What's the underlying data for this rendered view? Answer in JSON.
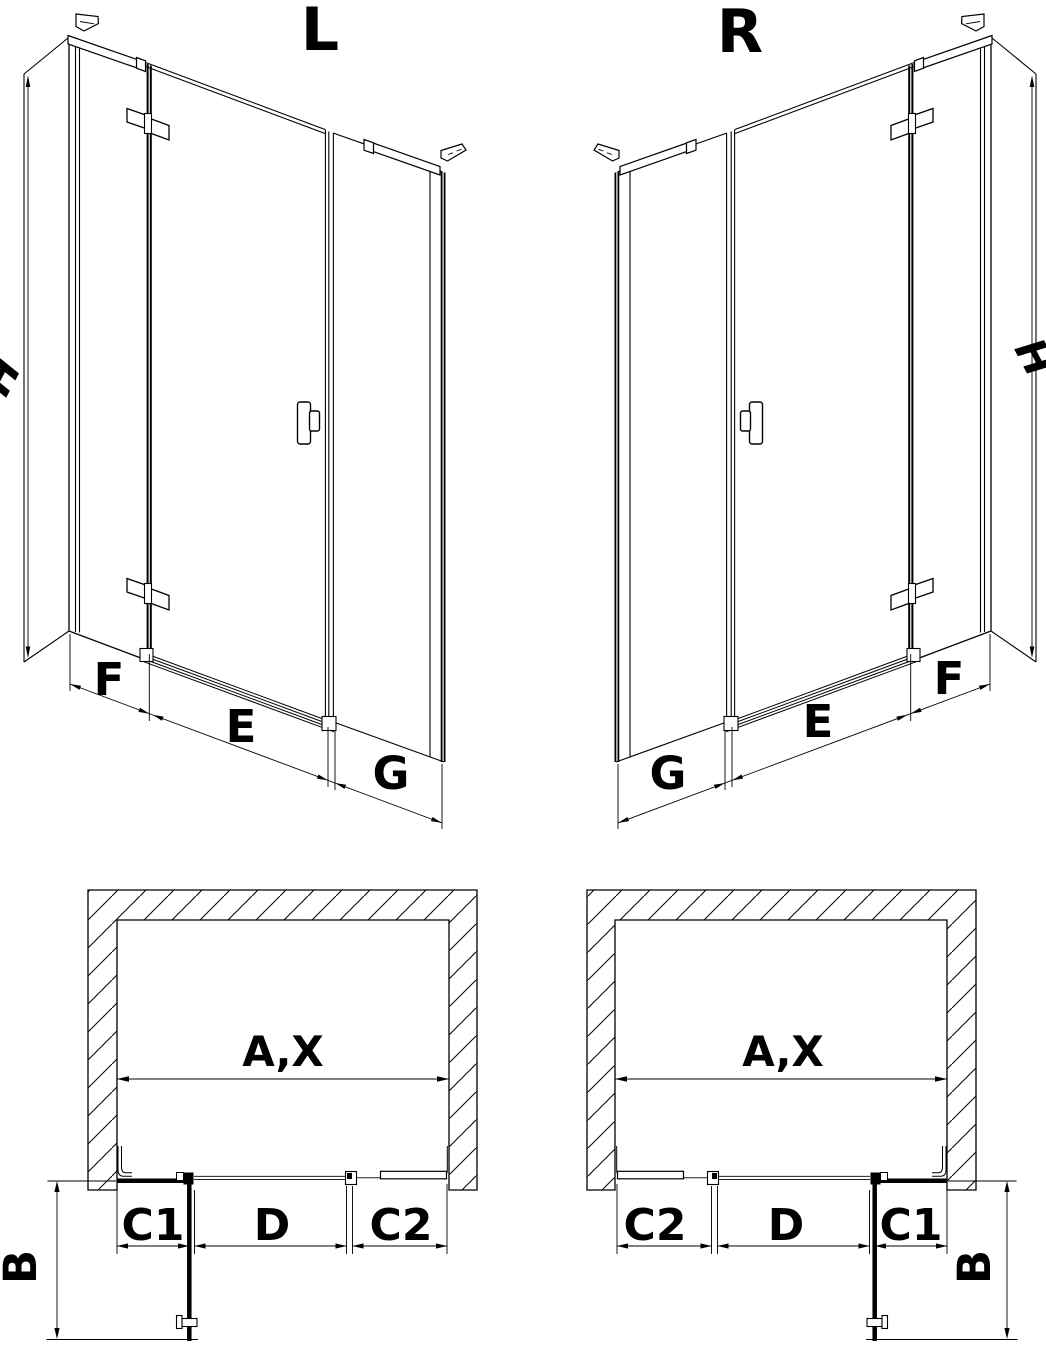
{
  "document": {
    "type": "shower-door-installation-diagram",
    "colors": {
      "line": "#000000",
      "background": "#ffffff"
    }
  },
  "elevations": {
    "left": {
      "label": "L",
      "height": "H",
      "fixed_panel": "F",
      "door": "E",
      "side_panel": "G"
    },
    "right": {
      "label": "R",
      "height": "H",
      "fixed_panel": "F",
      "door": "E",
      "side_panel": "G"
    }
  },
  "plans": {
    "left": {
      "opening_width": "A,X",
      "fixed1": "C1",
      "door_opening": "D",
      "fixed2": "C2",
      "depth": "B"
    },
    "right": {
      "opening_width": "A,X",
      "fixed1": "C1",
      "door_opening": "D",
      "fixed2": "C2",
      "depth": "B"
    }
  }
}
